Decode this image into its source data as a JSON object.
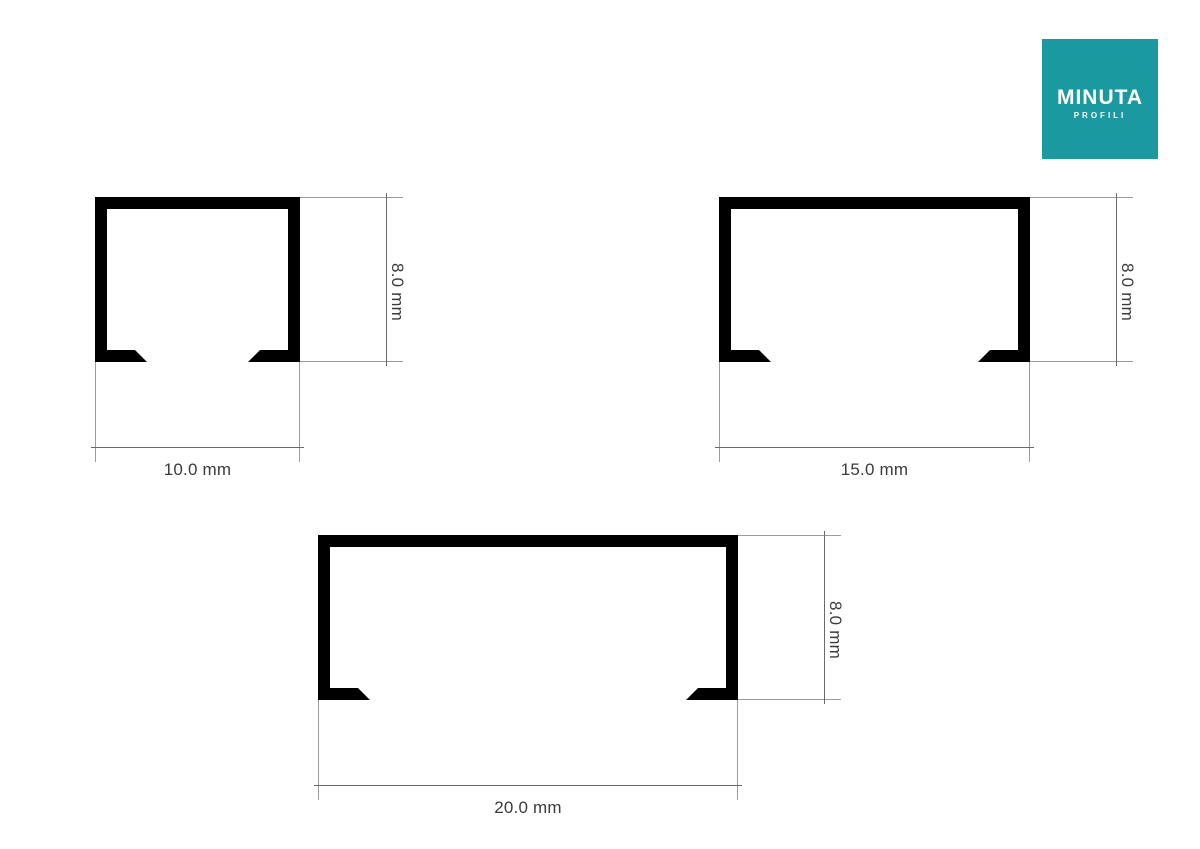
{
  "page": {
    "background_color": "#ffffff"
  },
  "logo": {
    "title": "MINUTA",
    "subtitle": "PROFILI",
    "background_color": "#1a9aa0",
    "text_color": "#ffffff"
  },
  "figures": [
    {
      "id": "profile-10mm",
      "width_mm": 10.0,
      "height_mm": 8.0,
      "width_label": "10.0 mm",
      "height_label": "8.0 mm"
    },
    {
      "id": "profile-15mm",
      "width_mm": 15.0,
      "height_mm": 8.0,
      "width_label": "15.0 mm",
      "height_label": "8.0 mm"
    },
    {
      "id": "profile-20mm",
      "width_mm": 20.0,
      "height_mm": 8.0,
      "width_label": "20.0 mm",
      "height_label": "8.0 mm"
    }
  ],
  "colors": {
    "profile_fill": "#000000",
    "extension_line": "#9c9c9c",
    "dimension_line": "#6a6a6a",
    "dimension_text": "#3b3b3b"
  }
}
